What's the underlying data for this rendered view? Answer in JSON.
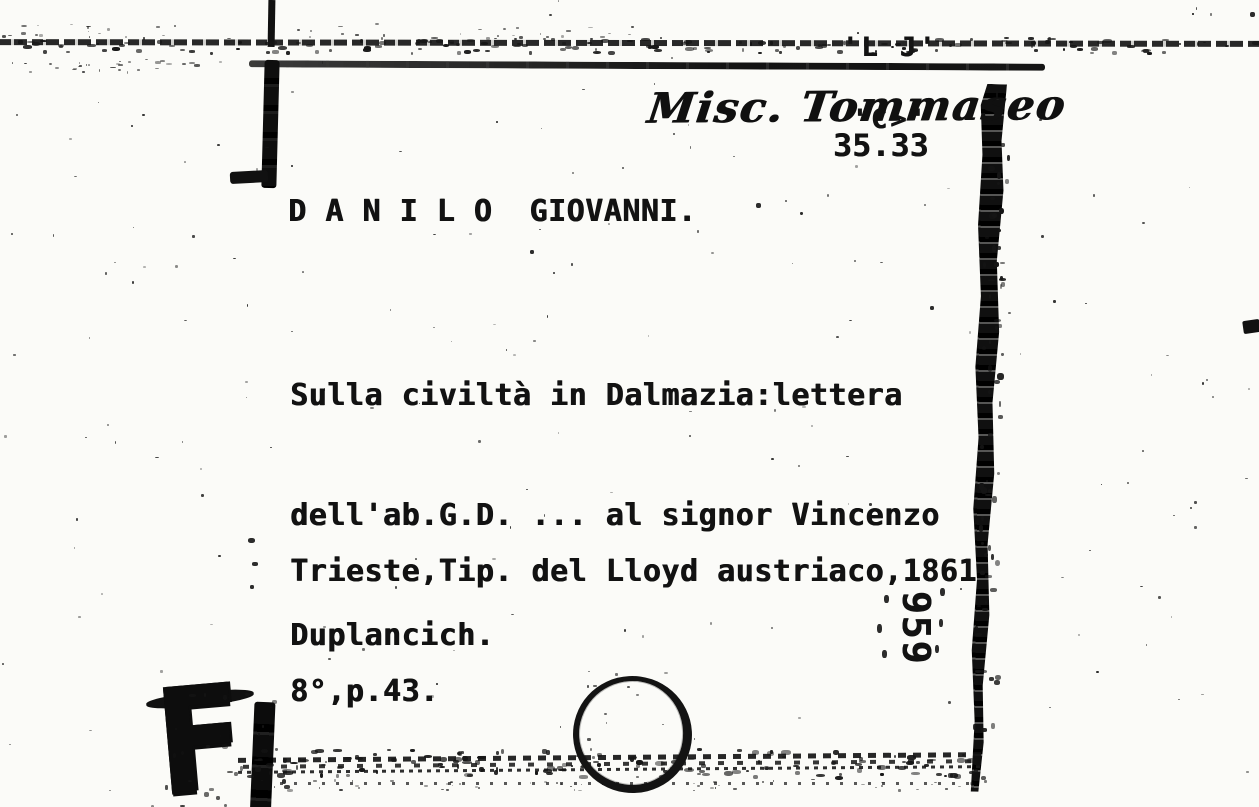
{
  "scan": {
    "handwritten_heading": "Misc. Tommaseo",
    "shelfmark": "35.33",
    "author_heading": "D A N I L O  GIOVANNI.",
    "title_lines": [
      "Sulla civiltà in Dalmazia:lettera",
      "dell'ab.G.D. ... al signor Vincenzo",
      "Duplancich."
    ],
    "imprint_line1": "Trieste,Tip. del Lloyd austriaco,1861",
    "imprint_line2": "8°,p.43.",
    "side_inventory_number": "959",
    "edge_fragments": [
      "'L J'",
      "'C>'"
    ],
    "corner_mark": "F",
    "ink_color": "#121212",
    "paper_color": "#fbfbf8"
  }
}
